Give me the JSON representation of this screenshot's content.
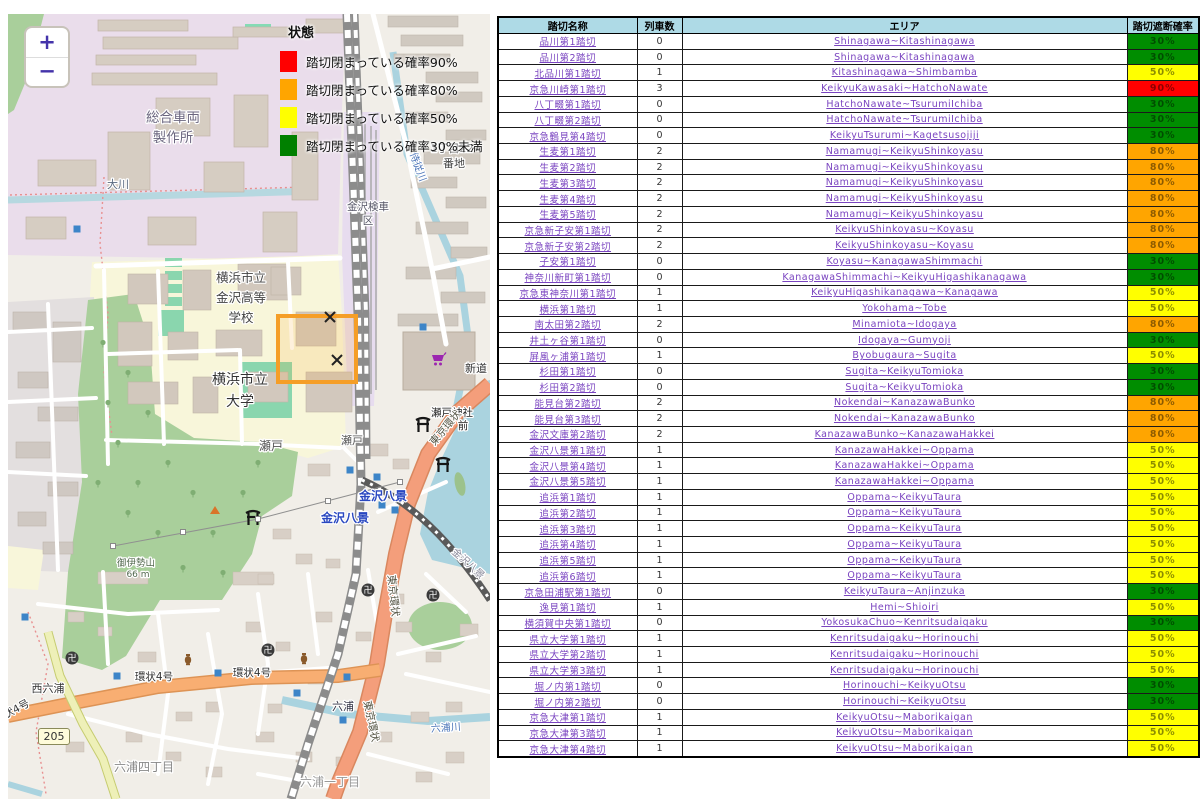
{
  "map": {
    "zoom_in_label": "+",
    "zoom_out_label": "−",
    "road_badge": "205",
    "legend": {
      "title": "状態",
      "items": [
        {
          "color": "#ff0000",
          "label": "踏切閉まっている確率90%"
        },
        {
          "color": "#ffa500",
          "label": "踏切閉まっている確率80%"
        },
        {
          "color": "#ffff00",
          "label": "踏切閉まっている確率50%"
        },
        {
          "color": "#008000",
          "label": "踏切閉まっている確率30%未満"
        }
      ]
    },
    "labels": [
      {
        "text": "総合車両",
        "x": 165,
        "y": 108,
        "size": 13.5,
        "color": "#6b667f"
      },
      {
        "text": "製作所",
        "x": 165,
        "y": 128,
        "size": 13.5,
        "color": "#6b667f"
      },
      {
        "text": "大川",
        "x": 110,
        "y": 174,
        "size": 11,
        "color": "#5a6a80"
      },
      {
        "text": "横浜市立",
        "x": 233,
        "y": 268,
        "size": 12.5,
        "color": "#444444"
      },
      {
        "text": "金沢高等",
        "x": 233,
        "y": 288,
        "size": 12.5,
        "color": "#444444"
      },
      {
        "text": "学校",
        "x": 233,
        "y": 308,
        "size": 12.5,
        "color": "#444444"
      },
      {
        "text": "横浜市立",
        "x": 232,
        "y": 370,
        "size": 14,
        "color": "#333333"
      },
      {
        "text": "大学",
        "x": 232,
        "y": 392,
        "size": 14,
        "color": "#333333"
      },
      {
        "text": "金沢検車",
        "x": 360,
        "y": 196,
        "size": 10.5,
        "color": "#555566"
      },
      {
        "text": "区",
        "x": 360,
        "y": 210,
        "size": 10.5,
        "color": "#555566"
      },
      {
        "text": "1丁目22",
        "x": 444,
        "y": 138,
        "size": 11,
        "color": "#444444"
      },
      {
        "text": "番地",
        "x": 446,
        "y": 153,
        "size": 11,
        "color": "#444444"
      },
      {
        "text": "瀬戸",
        "x": 263,
        "y": 436,
        "size": 12,
        "color": "#555555"
      },
      {
        "text": "瀬戸",
        "x": 344,
        "y": 430,
        "size": 11,
        "color": "#555555"
      },
      {
        "text": "瀬戸神社",
        "x": 444,
        "y": 402,
        "size": 10.5,
        "color": "#222222"
      },
      {
        "text": "前",
        "x": 455,
        "y": 415,
        "size": 10.5,
        "color": "#222222"
      },
      {
        "text": "金沢八景",
        "x": 375,
        "y": 486,
        "size": 12,
        "color": "#2947c0",
        "bold": true
      },
      {
        "text": "金沢八景",
        "x": 337,
        "y": 508,
        "size": 12,
        "color": "#2947c0",
        "bold": true
      },
      {
        "text": "六浦",
        "x": 335,
        "y": 696,
        "size": 11,
        "color": "#333344"
      },
      {
        "text": "御伊勢山",
        "x": 128,
        "y": 552,
        "size": 9.5,
        "color": "#53694f"
      },
      {
        "text": "66 m",
        "x": 130,
        "y": 563,
        "size": 9,
        "color": "#53694f"
      },
      {
        "text": "西六浦",
        "x": 40,
        "y": 678,
        "size": 11,
        "color": "#333333"
      },
      {
        "text": "環状4号",
        "x": 146,
        "y": 666,
        "size": 10.5,
        "color": "#333333"
      },
      {
        "text": "環状4号",
        "x": 244,
        "y": 662,
        "size": 10.5,
        "color": "#333333"
      },
      {
        "text": "状4号",
        "x": 10,
        "y": 698,
        "size": 10.5,
        "color": "#333333",
        "rotate": -28
      },
      {
        "text": "六浦四丁目",
        "x": 136,
        "y": 757,
        "size": 12,
        "color": "#888888"
      },
      {
        "text": "六浦一丁目",
        "x": 322,
        "y": 772,
        "size": 12,
        "color": "#999999"
      },
      {
        "text": "六浦川",
        "x": 438,
        "y": 717,
        "size": 10,
        "color": "#4a74b8",
        "rotate": -4
      },
      {
        "text": "侍従川",
        "x": 407,
        "y": 154,
        "size": 10,
        "color": "#4a74b8",
        "rotate": 70
      },
      {
        "text": "新道",
        "x": 468,
        "y": 358,
        "size": 11,
        "color": "#333333"
      },
      {
        "text": "東京環状",
        "x": 440,
        "y": 416,
        "size": 10.5,
        "color": "#555544",
        "rotate": -50
      },
      {
        "text": "東京環状",
        "x": 382,
        "y": 582,
        "size": 10.5,
        "color": "#555544",
        "rotate": 84
      },
      {
        "text": "東京環状",
        "x": 360,
        "y": 708,
        "size": 10.5,
        "color": "#555544",
        "rotate": 78
      },
      {
        "text": "金沢八景",
        "x": 458,
        "y": 552,
        "size": 10,
        "color": "#888899",
        "rotate": 42
      }
    ],
    "icons": [
      {
        "type": "torii",
        "x": 415,
        "y": 411
      },
      {
        "type": "torii",
        "x": 435,
        "y": 451
      },
      {
        "type": "torii",
        "x": 245,
        "y": 504
      },
      {
        "type": "temple",
        "x": 64,
        "y": 644
      },
      {
        "type": "temple",
        "x": 360,
        "y": 576
      },
      {
        "type": "temple",
        "x": 425,
        "y": 581
      },
      {
        "type": "temple",
        "x": 260,
        "y": 636
      },
      {
        "type": "cart",
        "x": 430,
        "y": 346
      },
      {
        "type": "vase",
        "x": 180,
        "y": 646
      },
      {
        "type": "vase",
        "x": 296,
        "y": 645
      },
      {
        "type": "peak",
        "x": 207,
        "y": 496
      },
      {
        "type": "crossing",
        "x": 322,
        "y": 303
      },
      {
        "type": "crossing",
        "x": 329,
        "y": 346
      },
      {
        "type": "bluesq",
        "x": 69,
        "y": 215
      },
      {
        "type": "bluesq",
        "x": 415,
        "y": 313
      },
      {
        "type": "bluesq",
        "x": 342,
        "y": 456
      },
      {
        "type": "bluesq",
        "x": 369,
        "y": 463
      },
      {
        "type": "bluesq",
        "x": 374,
        "y": 491
      },
      {
        "type": "bluesq",
        "x": 387,
        "y": 496
      },
      {
        "type": "bluesq",
        "x": 17,
        "y": 603
      },
      {
        "type": "bluesq",
        "x": 109,
        "y": 662
      },
      {
        "type": "bluesq",
        "x": 210,
        "y": 659
      },
      {
        "type": "bluesq",
        "x": 339,
        "y": 663
      },
      {
        "type": "bluesq",
        "x": 289,
        "y": 679
      },
      {
        "type": "bluesq",
        "x": 335,
        "y": 706
      },
      {
        "type": "node",
        "x": 105,
        "y": 532
      },
      {
        "type": "node",
        "x": 175,
        "y": 518
      },
      {
        "type": "node",
        "x": 250,
        "y": 505
      },
      {
        "type": "node",
        "x": 320,
        "y": 487
      },
      {
        "type": "node",
        "x": 392,
        "y": 468
      },
      {
        "type": "tree",
        "x": 95,
        "y": 330
      },
      {
        "type": "tree",
        "x": 120,
        "y": 360
      },
      {
        "type": "tree",
        "x": 140,
        "y": 400
      },
      {
        "type": "tree",
        "x": 110,
        "y": 430
      },
      {
        "type": "tree",
        "x": 160,
        "y": 450
      },
      {
        "type": "tree",
        "x": 185,
        "y": 480
      },
      {
        "type": "tree",
        "x": 205,
        "y": 520
      },
      {
        "type": "tree",
        "x": 150,
        "y": 520
      },
      {
        "type": "tree",
        "x": 120,
        "y": 500
      },
      {
        "type": "tree",
        "x": 90,
        "y": 470
      },
      {
        "type": "tree",
        "x": 175,
        "y": 555
      },
      {
        "type": "tree",
        "x": 215,
        "y": 560
      },
      {
        "type": "tree",
        "x": 235,
        "y": 480
      },
      {
        "type": "tree",
        "x": 250,
        "y": 450
      },
      {
        "type": "tree",
        "x": 100,
        "y": 390
      },
      {
        "type": "tree",
        "x": 130,
        "y": 470
      }
    ]
  },
  "table": {
    "headers": [
      "踏切名称",
      "列車数",
      "エリア",
      "踏切遮断確率"
    ],
    "level_colors": {
      "green": "#008d00",
      "yellow": "#ffff00",
      "orange": "#ffa500",
      "red": "#ff0000"
    },
    "rows": [
      {
        "name": "品川第1踏切",
        "trains": "0",
        "area": "Shinagawa~Kitashinagawa",
        "prob": "30%",
        "level": "green"
      },
      {
        "name": "品川第2踏切",
        "trains": "0",
        "area": "Shinagawa~Kitashinagawa",
        "prob": "30%",
        "level": "green"
      },
      {
        "name": "北品川第1踏切",
        "trains": "1",
        "area": "Kitashinagawa~Shimbamba",
        "prob": "50%",
        "level": "yellow"
      },
      {
        "name": "京急川崎第1踏切",
        "trains": "3",
        "area": "KeikyuKawasaki~HatchoNawate",
        "prob": "90%",
        "level": "red"
      },
      {
        "name": "八丁畷第1踏切",
        "trains": "0",
        "area": "HatchoNawate~TsurumiIchiba",
        "prob": "30%",
        "level": "green"
      },
      {
        "name": "八丁畷第2踏切",
        "trains": "0",
        "area": "HatchoNawate~TsurumiIchiba",
        "prob": "30%",
        "level": "green"
      },
      {
        "name": "京急鶴見第4踏切",
        "trains": "0",
        "area": "KeikyuTsurumi~Kagetsusojiji",
        "prob": "30%",
        "level": "green"
      },
      {
        "name": "生麦第1踏切",
        "trains": "2",
        "area": "Namamugi~KeikyuShinkoyasu",
        "prob": "80%",
        "level": "orange"
      },
      {
        "name": "生麦第2踏切",
        "trains": "2",
        "area": "Namamugi~KeikyuShinkoyasu",
        "prob": "80%",
        "level": "orange"
      },
      {
        "name": "生麦第3踏切",
        "trains": "2",
        "area": "Namamugi~KeikyuShinkoyasu",
        "prob": "80%",
        "level": "orange"
      },
      {
        "name": "生麦第4踏切",
        "trains": "2",
        "area": "Namamugi~KeikyuShinkoyasu",
        "prob": "80%",
        "level": "orange"
      },
      {
        "name": "生麦第5踏切",
        "trains": "2",
        "area": "Namamugi~KeikyuShinkoyasu",
        "prob": "80%",
        "level": "orange"
      },
      {
        "name": "京急新子安第1踏切",
        "trains": "2",
        "area": "KeikyuShinkoyasu~Koyasu",
        "prob": "80%",
        "level": "orange"
      },
      {
        "name": "京急新子安第2踏切",
        "trains": "2",
        "area": "KeikyuShinkoyasu~Koyasu",
        "prob": "80%",
        "level": "orange"
      },
      {
        "name": "子安第1踏切",
        "trains": "0",
        "area": "Koyasu~KanagawaShimmachi",
        "prob": "30%",
        "level": "green"
      },
      {
        "name": "神奈川新町第1踏切",
        "trains": "0",
        "area": "KanagawaShimmachi~KeikyuHigashikanagawa",
        "prob": "30%",
        "level": "green"
      },
      {
        "name": "京急東神奈川第1踏切",
        "trains": "1",
        "area": "KeikyuHigashikanagawa~Kanagawa",
        "prob": "50%",
        "level": "yellow"
      },
      {
        "name": "横浜第1踏切",
        "trains": "1",
        "area": "Yokohama~Tobe",
        "prob": "50%",
        "level": "yellow"
      },
      {
        "name": "南太田第2踏切",
        "trains": "2",
        "area": "Minamiota~Idogaya",
        "prob": "80%",
        "level": "orange"
      },
      {
        "name": "井土ヶ谷第1踏切",
        "trains": "0",
        "area": "Idogaya~Gumyoji",
        "prob": "30%",
        "level": "green"
      },
      {
        "name": "屏風ヶ浦第1踏切",
        "trains": "1",
        "area": "Byobugaura~Sugita",
        "prob": "50%",
        "level": "yellow"
      },
      {
        "name": "杉田第1踏切",
        "trains": "0",
        "area": "Sugita~KeikyuTomioka",
        "prob": "30%",
        "level": "green"
      },
      {
        "name": "杉田第2踏切",
        "trains": "0",
        "area": "Sugita~KeikyuTomioka",
        "prob": "30%",
        "level": "green"
      },
      {
        "name": "能見台第2踏切",
        "trains": "2",
        "area": "Nokendai~KanazawaBunko",
        "prob": "80%",
        "level": "orange"
      },
      {
        "name": "能見台第3踏切",
        "trains": "2",
        "area": "Nokendai~KanazawaBunko",
        "prob": "80%",
        "level": "orange"
      },
      {
        "name": "金沢文庫第2踏切",
        "trains": "2",
        "area": "KanazawaBunko~KanazawaHakkei",
        "prob": "80%",
        "level": "orange"
      },
      {
        "name": "金沢八景第1踏切",
        "trains": "1",
        "area": "KanazawaHakkei~Oppama",
        "prob": "50%",
        "level": "yellow"
      },
      {
        "name": "金沢八景第4踏切",
        "trains": "1",
        "area": "KanazawaHakkei~Oppama",
        "prob": "50%",
        "level": "yellow"
      },
      {
        "name": "金沢八景第5踏切",
        "trains": "1",
        "area": "KanazawaHakkei~Oppama",
        "prob": "50%",
        "level": "yellow"
      },
      {
        "name": "追浜第1踏切",
        "trains": "1",
        "area": "Oppama~KeikyuTaura",
        "prob": "50%",
        "level": "yellow"
      },
      {
        "name": "追浜第2踏切",
        "trains": "1",
        "area": "Oppama~KeikyuTaura",
        "prob": "50%",
        "level": "yellow"
      },
      {
        "name": "追浜第3踏切",
        "trains": "1",
        "area": "Oppama~KeikyuTaura",
        "prob": "50%",
        "level": "yellow"
      },
      {
        "name": "追浜第4踏切",
        "trains": "1",
        "area": "Oppama~KeikyuTaura",
        "prob": "50%",
        "level": "yellow"
      },
      {
        "name": "追浜第5踏切",
        "trains": "1",
        "area": "Oppama~KeikyuTaura",
        "prob": "50%",
        "level": "yellow"
      },
      {
        "name": "追浜第6踏切",
        "trains": "1",
        "area": "Oppama~KeikyuTaura",
        "prob": "50%",
        "level": "yellow"
      },
      {
        "name": "京急田浦駅第1踏切",
        "trains": "0",
        "area": "KeikyuTaura~Anjinzuka",
        "prob": "30%",
        "level": "green"
      },
      {
        "name": "逸見第1踏切",
        "trains": "1",
        "area": "Hemi~Shioiri",
        "prob": "50%",
        "level": "yellow"
      },
      {
        "name": "横須賀中央第1踏切",
        "trains": "0",
        "area": "YokosukaChuo~Kenritsudaigaku",
        "prob": "30%",
        "level": "green"
      },
      {
        "name": "県立大学第1踏切",
        "trains": "1",
        "area": "Kenritsudaigaku~Horinouchi",
        "prob": "50%",
        "level": "yellow"
      },
      {
        "name": "県立大学第2踏切",
        "trains": "1",
        "area": "Kenritsudaigaku~Horinouchi",
        "prob": "50%",
        "level": "yellow"
      },
      {
        "name": "県立大学第3踏切",
        "trains": "1",
        "area": "Kenritsudaigaku~Horinouchi",
        "prob": "50%",
        "level": "yellow"
      },
      {
        "name": "堀ノ内第1踏切",
        "trains": "0",
        "area": "Horinouchi~KeikyuOtsu",
        "prob": "30%",
        "level": "green"
      },
      {
        "name": "堀ノ内第2踏切",
        "trains": "0",
        "area": "Horinouchi~KeikyuOtsu",
        "prob": "30%",
        "level": "green"
      },
      {
        "name": "京急大津第1踏切",
        "trains": "1",
        "area": "KeikyuOtsu~Maborikaigan",
        "prob": "50%",
        "level": "yellow"
      },
      {
        "name": "京急大津第3踏切",
        "trains": "1",
        "area": "KeikyuOtsu~Maborikaigan",
        "prob": "50%",
        "level": "yellow"
      },
      {
        "name": "京急大津第4踏切",
        "trains": "1",
        "area": "KeikyuOtsu~Maborikaigan",
        "prob": "50%",
        "level": "yellow"
      }
    ]
  }
}
